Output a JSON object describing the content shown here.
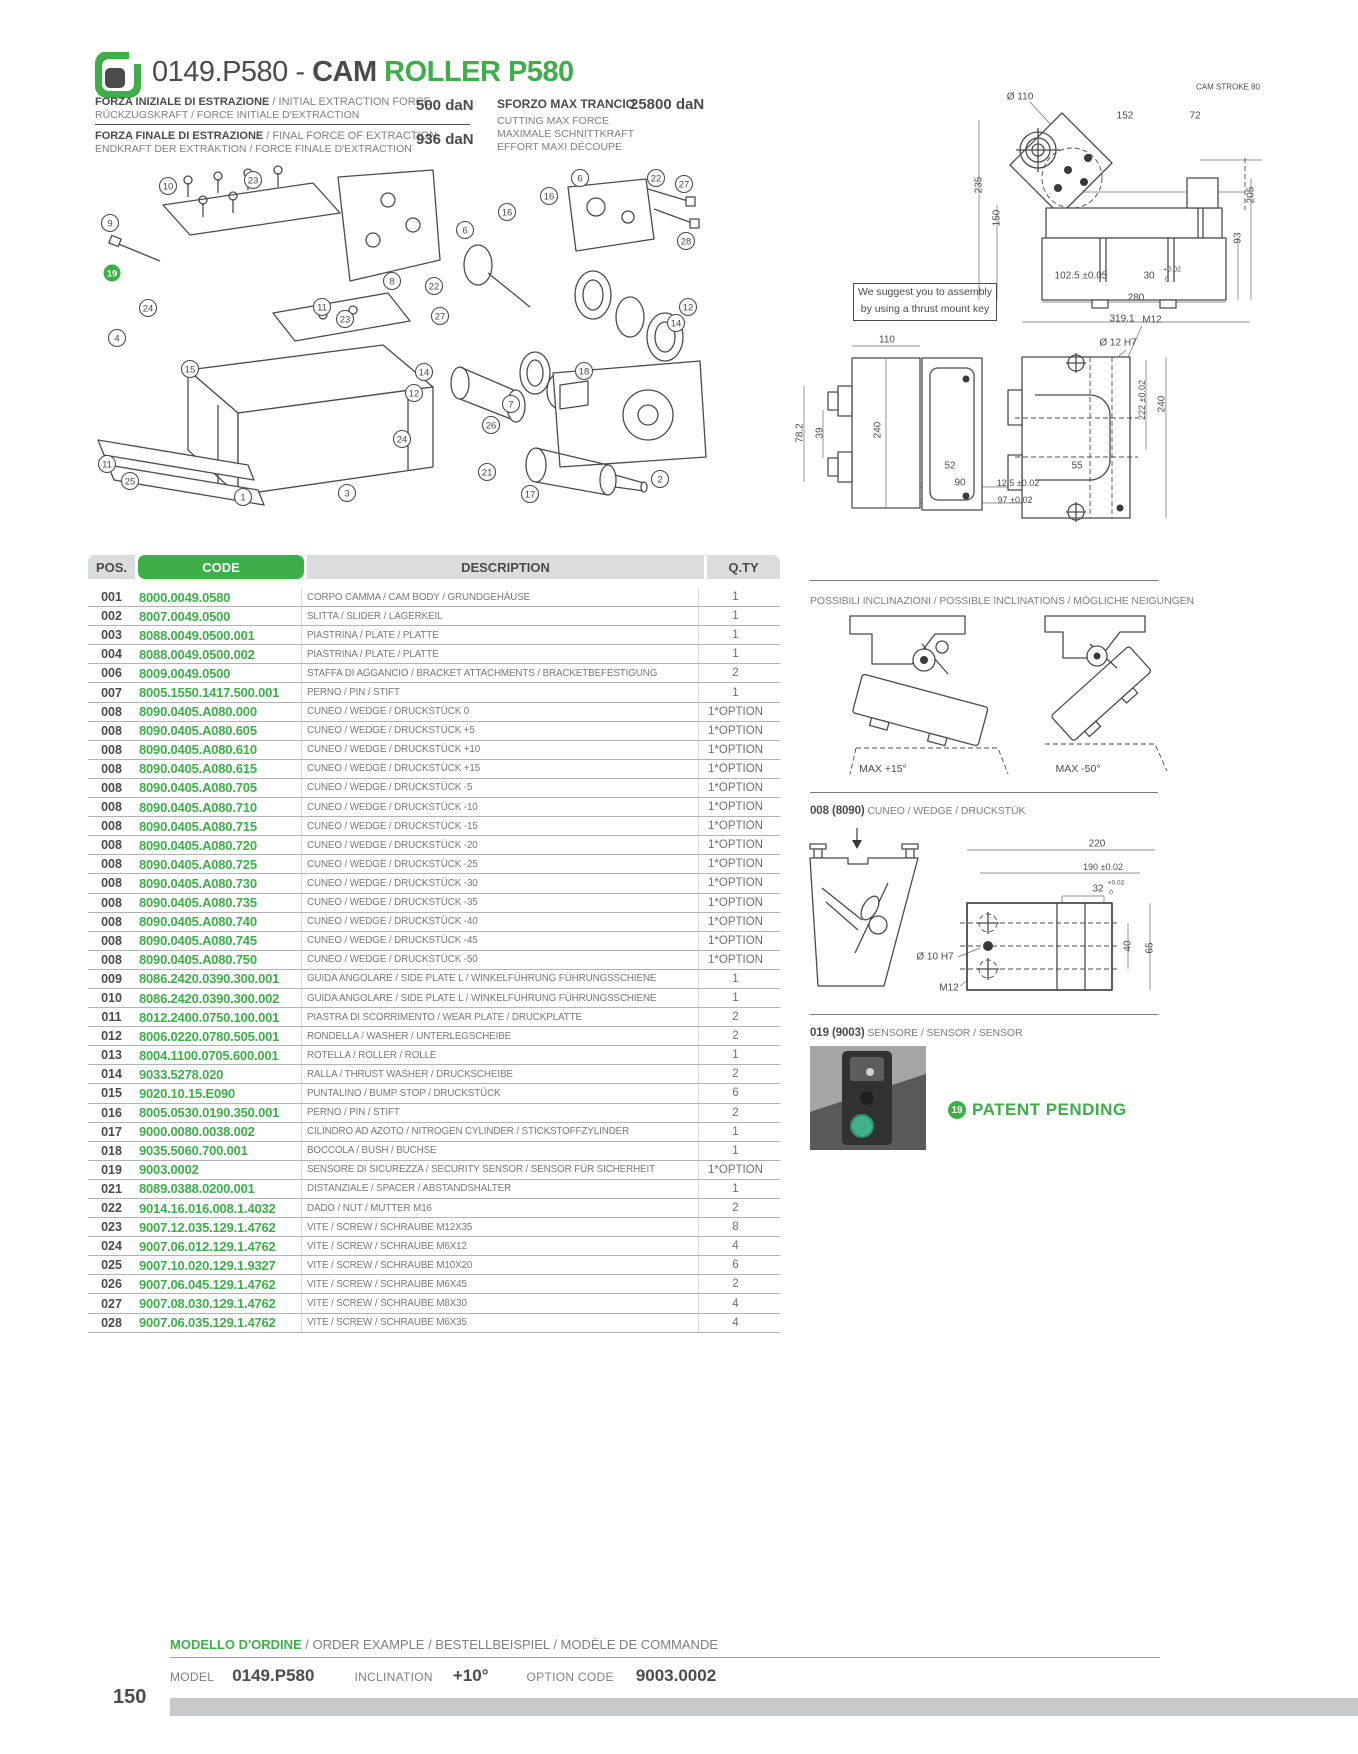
{
  "header": {
    "title_prefix": "0149.P580 - ",
    "title_cam": "CAM",
    "title_rest": " ROLLER P580"
  },
  "colors": {
    "green": "#3EAE49",
    "dark": "#4A4B4D",
    "gray": "#7D7F82"
  },
  "specs": {
    "initial": {
      "line1_bold": "FORZA INIZIALE DI ESTRAZIONE",
      "line1_rest": " / INITIAL EXTRACTION FORCE",
      "line2": "RÜCKZUGSKRAFT / FORCE INITIALE D'EXTRACTION",
      "value": "500 daN"
    },
    "final": {
      "line1_bold": "FORZA FINALE DI ESTRAZIONE",
      "line1_rest": " / FINAL FORCE OF EXTRACTION",
      "line2": "ENDKRAFT DER EXTRAKTION / FORCE FINALE D'EXTRACTION",
      "value": "936 daN"
    },
    "max_cut": {
      "title": "SFORZO MAX TRANCIO",
      "value": "25800 daN",
      "line1": "CUTTING MAX FORCE",
      "line2": "MAXIMALE SCHNITTKRAFT",
      "line3": "EFFORT MAXI DÉCOUPE"
    }
  },
  "note_box": {
    "line1": "We suggest you to assembly",
    "line2": "by using a thrust mount key"
  },
  "table": {
    "headers": {
      "pos": "POS.",
      "code": "CODE",
      "desc": "DESCRIPTION",
      "qty": "Q.TY"
    },
    "rows": [
      [
        "001",
        "8000.0049.0580",
        "CORPO CAMMA / CAM BODY / GRUNDGEHÄUSE",
        "1"
      ],
      [
        "002",
        "8007.0049.0500",
        "SLITTA / SLIDER / LAGERKEIL",
        "1"
      ],
      [
        "003",
        "8088.0049.0500.001",
        "PIASTRINA / PLATE / PLATTE",
        "1"
      ],
      [
        "004",
        "8088.0049.0500.002",
        "PIASTRINA / PLATE / PLATTE",
        "1"
      ],
      [
        "006",
        "8009.0049.0500",
        "STAFFA DI AGGANCIO / BRACKET ATTACHMENTS / BRACKETBEFESTIGUNG",
        "2"
      ],
      [
        "007",
        "8005.1550.1417.500.001",
        "PERNO / PIN / STIFT",
        "1"
      ],
      [
        "008",
        "8090.0405.A080.000",
        "CUNEO / WEDGE / DRUCKSTÜCK 0",
        "1*OPTION"
      ],
      [
        "008",
        "8090.0405.A080.605",
        "CUNEO / WEDGE / DRUCKSTÜCK +5",
        "1*OPTION"
      ],
      [
        "008",
        "8090.0405.A080.610",
        "CUNEO / WEDGE / DRUCKSTÜCK +10",
        "1*OPTION"
      ],
      [
        "008",
        "8090.0405.A080.615",
        "CUNEO / WEDGE / DRUCKSTÜCK +15",
        "1*OPTION"
      ],
      [
        "008",
        "8090.0405.A080.705",
        "CUNEO / WEDGE / DRUCKSTÜCK -5",
        "1*OPTION"
      ],
      [
        "008",
        "8090.0405.A080.710",
        "CUNEO / WEDGE / DRUCKSTÜCK -10",
        "1*OPTION"
      ],
      [
        "008",
        "8090.0405.A080.715",
        "CUNEO / WEDGE / DRUCKSTÜCK -15",
        "1*OPTION"
      ],
      [
        "008",
        "8090.0405.A080.720",
        "CUNEO / WEDGE / DRUCKSTÜCK -20",
        "1*OPTION"
      ],
      [
        "008",
        "8090.0405.A080.725",
        "CUNEO / WEDGE / DRUCKSTÜCK -25",
        "1*OPTION"
      ],
      [
        "008",
        "8090.0405.A080.730",
        "CUNEO / WEDGE / DRUCKSTÜCK -30",
        "1*OPTION"
      ],
      [
        "008",
        "8090.0405.A080.735",
        "CUNEO / WEDGE / DRUCKSTÜCK -35",
        "1*OPTION"
      ],
      [
        "008",
        "8090.0405.A080.740",
        "CUNEO / WEDGE / DRUCKSTÜCK -40",
        "1*OPTION"
      ],
      [
        "008",
        "8090.0405.A080.745",
        "CUNEO / WEDGE / DRUCKSTÜCK -45",
        "1*OPTION"
      ],
      [
        "008",
        "8090.0405.A080.750",
        "CUNEO / WEDGE / DRUCKSTÜCK -50",
        "1*OPTION"
      ],
      [
        "009",
        "8086.2420.0390.300.001",
        "GUIDA ANGOLARE / SIDE PLATE L / WINKELFÜHRUNG FÜHRUNGSSCHIENE",
        "1"
      ],
      [
        "010",
        "8086.2420.0390.300.002",
        "GUIDA ANGOLARE / SIDE PLATE L / WINKELFÜHRUNG FÜHRUNGSSCHIENE",
        "1"
      ],
      [
        "011",
        "8012.2400.0750.100.001",
        "PIASTRA DI SCORRIMENTO / WEAR PLATE / DRUCKPLATTE",
        "2"
      ],
      [
        "012",
        "8006.0220.0780.505.001",
        "RONDELLA / WASHER / UNTERLEGSCHEIBE",
        "2"
      ],
      [
        "013",
        "8004.1100.0705.600.001",
        "ROTELLA / ROLLER / ROLLE",
        "1"
      ],
      [
        "014",
        "9033.5278.020",
        "RALLA / THRUST WASHER / DRUCKSCHEIBE",
        "2"
      ],
      [
        "015",
        "9020.10.15.E090",
        "PUNTALINO / BUMP STOP / DRUCKSTÜCK",
        "6"
      ],
      [
        "016",
        "8005.0530.0190.350.001",
        "PERNO / PIN / STIFT",
        "2"
      ],
      [
        "017",
        "9000.0080.0038.002",
        "CILINDRO AD AZOTO / NITROGEN CYLINDER / STICKSTOFFZYLINDER",
        "1"
      ],
      [
        "018",
        "9035.5060.700.001",
        "BOCCOLA / BUSH / BUCHSE",
        "1"
      ],
      [
        "019",
        "9003.0002",
        "SENSORE DI SICUREZZA / SECURITY SENSOR / SENSOR FÜR SICHERHEIT",
        "1*OPTION"
      ],
      [
        "021",
        "8089.0388.0200.001",
        "DISTANZIALE / SPACER / ABSTANDSHALTER",
        "1"
      ],
      [
        "022",
        "9014.16.016.008.1.4032",
        "DADO / NUT / MUTTER M16",
        "2"
      ],
      [
        "023",
        "9007.12.035.129.1.4762",
        "VITE / SCREW / SCHRAUBE M12X35",
        "8"
      ],
      [
        "024",
        "9007.06.012.129.1.4762",
        "VITE / SCREW / SCHRAUBE M6X12",
        "4"
      ],
      [
        "025",
        "9007.10.020.129.1.9327",
        "VITE / SCREW / SCHRAUBE M10X20",
        "6"
      ],
      [
        "026",
        "9007.06.045.129.1.4762",
        "VITE / SCREW / SCHRAUBE M6X45",
        "2"
      ],
      [
        "027",
        "9007.08.030.129.1.4762",
        "VITE / SCREW / SCHRAUBE M8X30",
        "4"
      ],
      [
        "028",
        "9007.06.035.129.1.4762",
        "VITE / SCREW / SCHRAUBE M6X35",
        "4"
      ]
    ]
  },
  "exploded": {
    "balloons": [
      {
        "n": "10",
        "x": 80,
        "y": 21
      },
      {
        "n": "23",
        "x": 165,
        "y": 15
      },
      {
        "n": "6",
        "x": 492,
        "y": 13
      },
      {
        "n": "22",
        "x": 568,
        "y": 13
      },
      {
        "n": "27",
        "x": 596,
        "y": 19
      },
      {
        "n": "16",
        "x": 461,
        "y": 31
      },
      {
        "n": "16",
        "x": 419,
        "y": 47
      },
      {
        "n": "9",
        "x": 22,
        "y": 58
      },
      {
        "n": "6",
        "x": 377,
        "y": 65
      },
      {
        "n": "28",
        "x": 598,
        "y": 76
      },
      {
        "n": "19",
        "x": 24,
        "y": 108,
        "g": true
      },
      {
        "n": "8",
        "x": 304,
        "y": 116
      },
      {
        "n": "22",
        "x": 346,
        "y": 121
      },
      {
        "n": "11",
        "x": 234,
        "y": 142
      },
      {
        "n": "23",
        "x": 257,
        "y": 154
      },
      {
        "n": "27",
        "x": 352,
        "y": 151
      },
      {
        "n": "24",
        "x": 60,
        "y": 143
      },
      {
        "n": "12",
        "x": 600,
        "y": 142
      },
      {
        "n": "14",
        "x": 588,
        "y": 158
      },
      {
        "n": "4",
        "x": 29,
        "y": 173
      },
      {
        "n": "15",
        "x": 102,
        "y": 204
      },
      {
        "n": "14",
        "x": 336,
        "y": 207
      },
      {
        "n": "18",
        "x": 496,
        "y": 206
      },
      {
        "n": "12",
        "x": 326,
        "y": 228
      },
      {
        "n": "7",
        "x": 423,
        "y": 239
      },
      {
        "n": "26",
        "x": 403,
        "y": 260
      },
      {
        "n": "24",
        "x": 314,
        "y": 274
      },
      {
        "n": "11",
        "x": 19,
        "y": 299
      },
      {
        "n": "21",
        "x": 399,
        "y": 307
      },
      {
        "n": "2",
        "x": 572,
        "y": 314
      },
      {
        "n": "25",
        "x": 42,
        "y": 316
      },
      {
        "n": "1",
        "x": 155,
        "y": 332
      },
      {
        "n": "3",
        "x": 259,
        "y": 328
      },
      {
        "n": "17",
        "x": 442,
        "y": 329
      }
    ]
  },
  "dims": {
    "top": [
      {
        "t": "Ø 110",
        "x": 70,
        "y": 27
      },
      {
        "t": "152",
        "x": 175,
        "y": 46
      },
      {
        "t": "72",
        "x": 245,
        "y": 46
      },
      {
        "t": "CAM STROKE 80",
        "x": 278,
        "y": 17,
        "fs": 8
      },
      {
        "t": "235",
        "x": 29,
        "y": 115,
        "r": 1
      },
      {
        "t": "150",
        "x": 47,
        "y": 148,
        "r": 1
      },
      {
        "t": "205",
        "x": 301,
        "y": 125,
        "r": 1
      },
      {
        "t": "93",
        "x": 288,
        "y": 168,
        "r": 1
      },
      {
        "t": "102.5 ±0.05",
        "x": 131,
        "y": 206
      },
      {
        "t": "30",
        "x": 199,
        "y": 206
      },
      {
        "t": "+0.02",
        "x": 222,
        "y": 200,
        "fs": 7
      },
      {
        "t": "0",
        "x": 217,
        "y": 210,
        "fs": 7
      },
      {
        "t": "280",
        "x": 186,
        "y": 228
      },
      {
        "t": "319.1",
        "x": 172,
        "y": 249
      }
    ],
    "mid": [
      {
        "t": "110",
        "x": 97,
        "y": 40
      },
      {
        "t": "78.2",
        "x": 10,
        "y": 133,
        "r": 1
      },
      {
        "t": "39",
        "x": 30,
        "y": 133,
        "r": 1
      },
      {
        "t": "240",
        "x": 88,
        "y": 130,
        "r": 1
      },
      {
        "t": "Ø 12 H7",
        "x": 328,
        "y": 43
      },
      {
        "t": "M12",
        "x": 362,
        "y": 20
      },
      {
        "t": "222 ±0.02",
        "x": 352,
        "y": 100,
        "r": 1,
        "fs": 9
      },
      {
        "t": "240",
        "x": 372,
        "y": 104,
        "r": 1
      },
      {
        "t": "52",
        "x": 160,
        "y": 166
      },
      {
        "t": "90",
        "x": 170,
        "y": 183
      },
      {
        "t": "12.5 ±0.02",
        "x": 228,
        "y": 183,
        "fs": 9
      },
      {
        "t": "97 ±0.02",
        "x": 225,
        "y": 200,
        "fs": 9
      },
      {
        "t": "55",
        "x": 287,
        "y": 166
      }
    ],
    "incl": [
      {
        "t": "MAX +15°",
        "x": 73,
        "y": 157,
        "fs": 10.5
      },
      {
        "t": "MAX -50°",
        "x": 268,
        "y": 157,
        "fs": 10.5
      }
    ],
    "wedge": [
      {
        "t": "220",
        "x": 287,
        "y": 16
      },
      {
        "t": "190 ±0.02",
        "x": 293,
        "y": 39,
        "fs": 9
      },
      {
        "t": "32",
        "x": 288,
        "y": 61
      },
      {
        "t": "+0.02",
        "x": 306,
        "y": 55,
        "fs": 6.5
      },
      {
        "t": "0",
        "x": 301,
        "y": 65,
        "fs": 6.5
      },
      {
        "t": "Ø 10 H7",
        "x": 125,
        "y": 129
      },
      {
        "t": "M12",
        "x": 139,
        "y": 160
      },
      {
        "t": "40",
        "x": 318,
        "y": 118,
        "r": 1
      },
      {
        "t": "65",
        "x": 340,
        "y": 120,
        "r": 1
      }
    ]
  },
  "sections": {
    "inclinations": {
      "heading": "POSSIBILI INCLINAZIONI / POSSIBLE INCLINATIONS / MÖGLICHE NEIGUNGEN"
    },
    "wedge": {
      "heading_bold": "008 (8090)",
      "heading_rest": " CUNEO / WEDGE / DRUCKSTÜK"
    },
    "sensor": {
      "heading_bold": "019 (9003)",
      "heading_rest": " SENSORE / SENSOR / SENSOR",
      "badge": "19",
      "patent": "PATENT PENDING"
    }
  },
  "order": {
    "heading_green": "MODELLO D'ORDINE",
    "heading_rest": " / ORDER EXAMPLE / BESTELLBEISPIEL / MODÈLE DE COMMANDE",
    "model_label": "MODEL",
    "model_value": "0149.P580",
    "inclination_label": "INCLINATION",
    "inclination_value": "+10°",
    "option_label": "OPTION CODE",
    "option_value": "9003.0002"
  },
  "footer": {
    "page_number": "150"
  }
}
